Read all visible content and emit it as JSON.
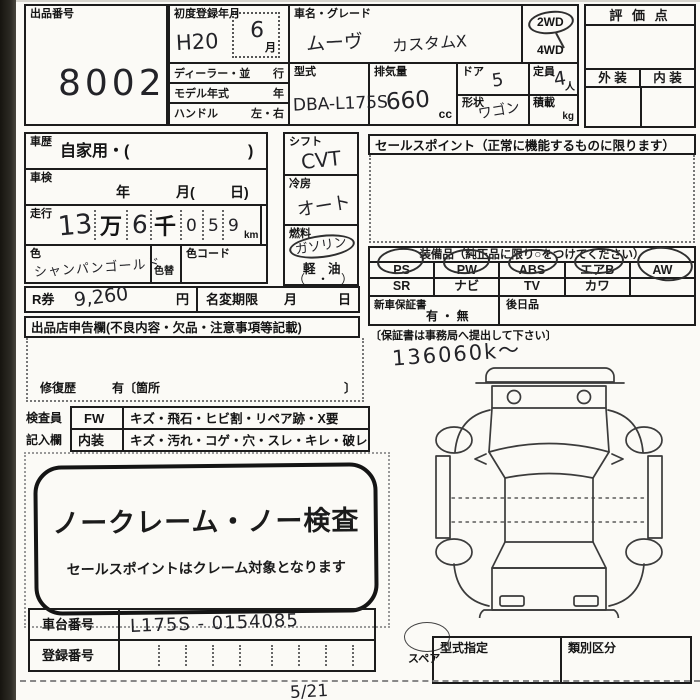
{
  "colors": {
    "paper": "#fbfaf6",
    "ink": "#1c1c1c",
    "handwriting": "#232328"
  },
  "lot": {
    "label": "出品番号",
    "number": "8002"
  },
  "reg": {
    "label": "初度登録年月",
    "year": "H20",
    "month": "6",
    "month_unit": "月"
  },
  "car": {
    "label": "車名・グレード",
    "name": "ムーヴ",
    "grade": "カスタムX"
  },
  "drive": {
    "two": "2WD",
    "four": "4WD"
  },
  "score": {
    "title": "評 価 点",
    "ext": "外 装",
    "int": "内 装"
  },
  "spec": {
    "dealer": "ディーラー・並",
    "dealer_r": "行",
    "model_year": "モデル年式",
    "model_year_r": "年",
    "handle": "ハンドル",
    "handle_r": "左・右",
    "model_label": "型式",
    "model_value": "DBA-L175S",
    "disp_label": "排気量",
    "disp_value": "660",
    "disp_unit": "cc",
    "door_label": "ドア",
    "door_value": "5",
    "shape_label": "形状",
    "shape_value": "ワゴン",
    "cap_label": "定員",
    "cap_value": "4",
    "cap_unit": "人",
    "load_label": "積載",
    "load_unit": "kg"
  },
  "history": {
    "label": "車歴",
    "value": "自家用・(",
    "close": ")"
  },
  "shaken": {
    "label": "車検",
    "y": "年",
    "m": "月(",
    "d": "日)"
  },
  "mileage": {
    "label": "走行",
    "man": "13",
    "man_unit": "万",
    "sen": "6",
    "sen_unit": "千",
    "d1": "0",
    "d2": "5",
    "d3": "9",
    "unit": "km"
  },
  "color": {
    "label": "色",
    "value": "シャンパンゴールド",
    "change": "色替",
    "code": "色コード"
  },
  "rticket": {
    "label": "R券",
    "value": "9,260",
    "yen": "円",
    "rename": "名変期限",
    "m": "月",
    "d": "日"
  },
  "decl": {
    "header": "出品店申告欄(不良内容・欠品・注意事項等記載)",
    "repair": "修復歴",
    "repair_v": "有〔箇所",
    "repair_c": "〕"
  },
  "inspect": {
    "l1": "検査員",
    "l2": "記入欄",
    "k1": "FW",
    "v1": "キズ・飛石・ヒビ割・リペア跡・X要",
    "k2": "内装",
    "v2": "キズ・汚れ・コゲ・穴・スレ・キレ・破レ"
  },
  "shift": {
    "label": "シフト",
    "value": "CVT"
  },
  "ac": {
    "label": "冷房",
    "value": "オート"
  },
  "fuel": {
    "label": "燃料",
    "value": "ガソリン",
    "alt": "軽　油",
    "paren": "（　・　）"
  },
  "sales": {
    "header": "セールスポイント（正常に機能するものに限ります）"
  },
  "equip": {
    "header": "装備品（純正品に限り○をつけてください）",
    "r1": [
      "PS",
      "PW",
      "ABS",
      "エアB",
      "AW"
    ],
    "r2": [
      "SR",
      "ナビ",
      "TV",
      "カワ",
      ""
    ]
  },
  "warranty": {
    "label": "新車保証書",
    "opts": "有 ・ 無",
    "later": "後日品",
    "note": "〔保証書は事務局へ提出して下さい〕",
    "mileage_note": "136060k〜"
  },
  "stamp": {
    "line1": "ノークレーム・ノー検査",
    "line2": "セールスポイントはクレーム対象となります"
  },
  "chassis": {
    "label": "車台番号",
    "value": "L175S - 0154085"
  },
  "regno": {
    "label": "登録番号"
  },
  "diagram": {
    "spare": "スペア"
  },
  "typebox": {
    "a": "型式指定",
    "b": "類別区分"
  },
  "footer": {
    "date": "5/21"
  }
}
